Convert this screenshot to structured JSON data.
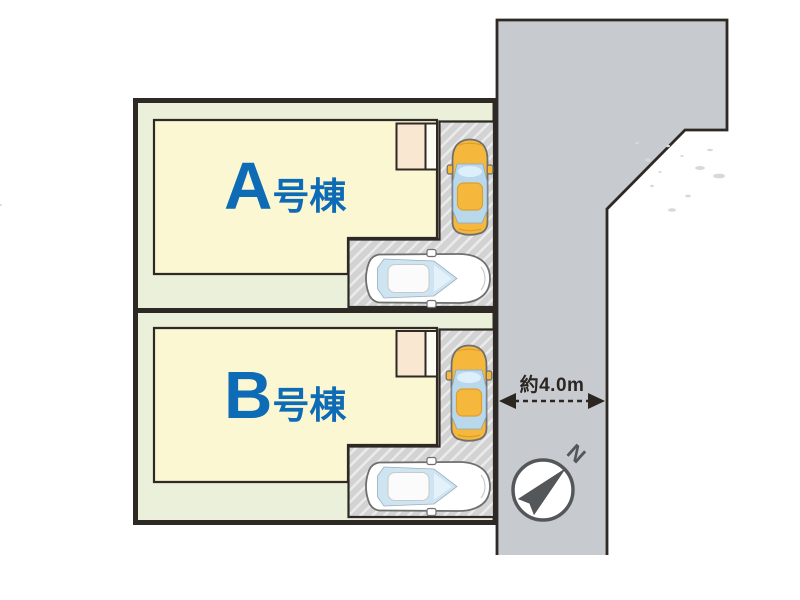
{
  "lots": [
    {
      "id": "A",
      "label_letter": "A",
      "label_suffix": "号棟"
    },
    {
      "id": "B",
      "label_letter": "B",
      "label_suffix": "号棟"
    }
  ],
  "road": {
    "width_label": "約4.0m"
  },
  "compass": {
    "north_label": "N"
  },
  "icons": {
    "compass": "north-arrow-icon",
    "road_width": "double-headed-arrow-icon",
    "cars": [
      "yellow-car-top-icon",
      "white-car-top-icon"
    ]
  },
  "colors": {
    "label_blue": "#0e6bb6",
    "lot_green": "#eaf0da",
    "building_cream": "#fcf7d3",
    "porch_peach": "#f9e7d2",
    "road_gray": "#c7cbcf",
    "parking_hatch_gray": "#d3d3d3",
    "car_yellow": "#f5b83d",
    "outline_dark": "#2e2925",
    "compass_gray": "#54575a"
  }
}
